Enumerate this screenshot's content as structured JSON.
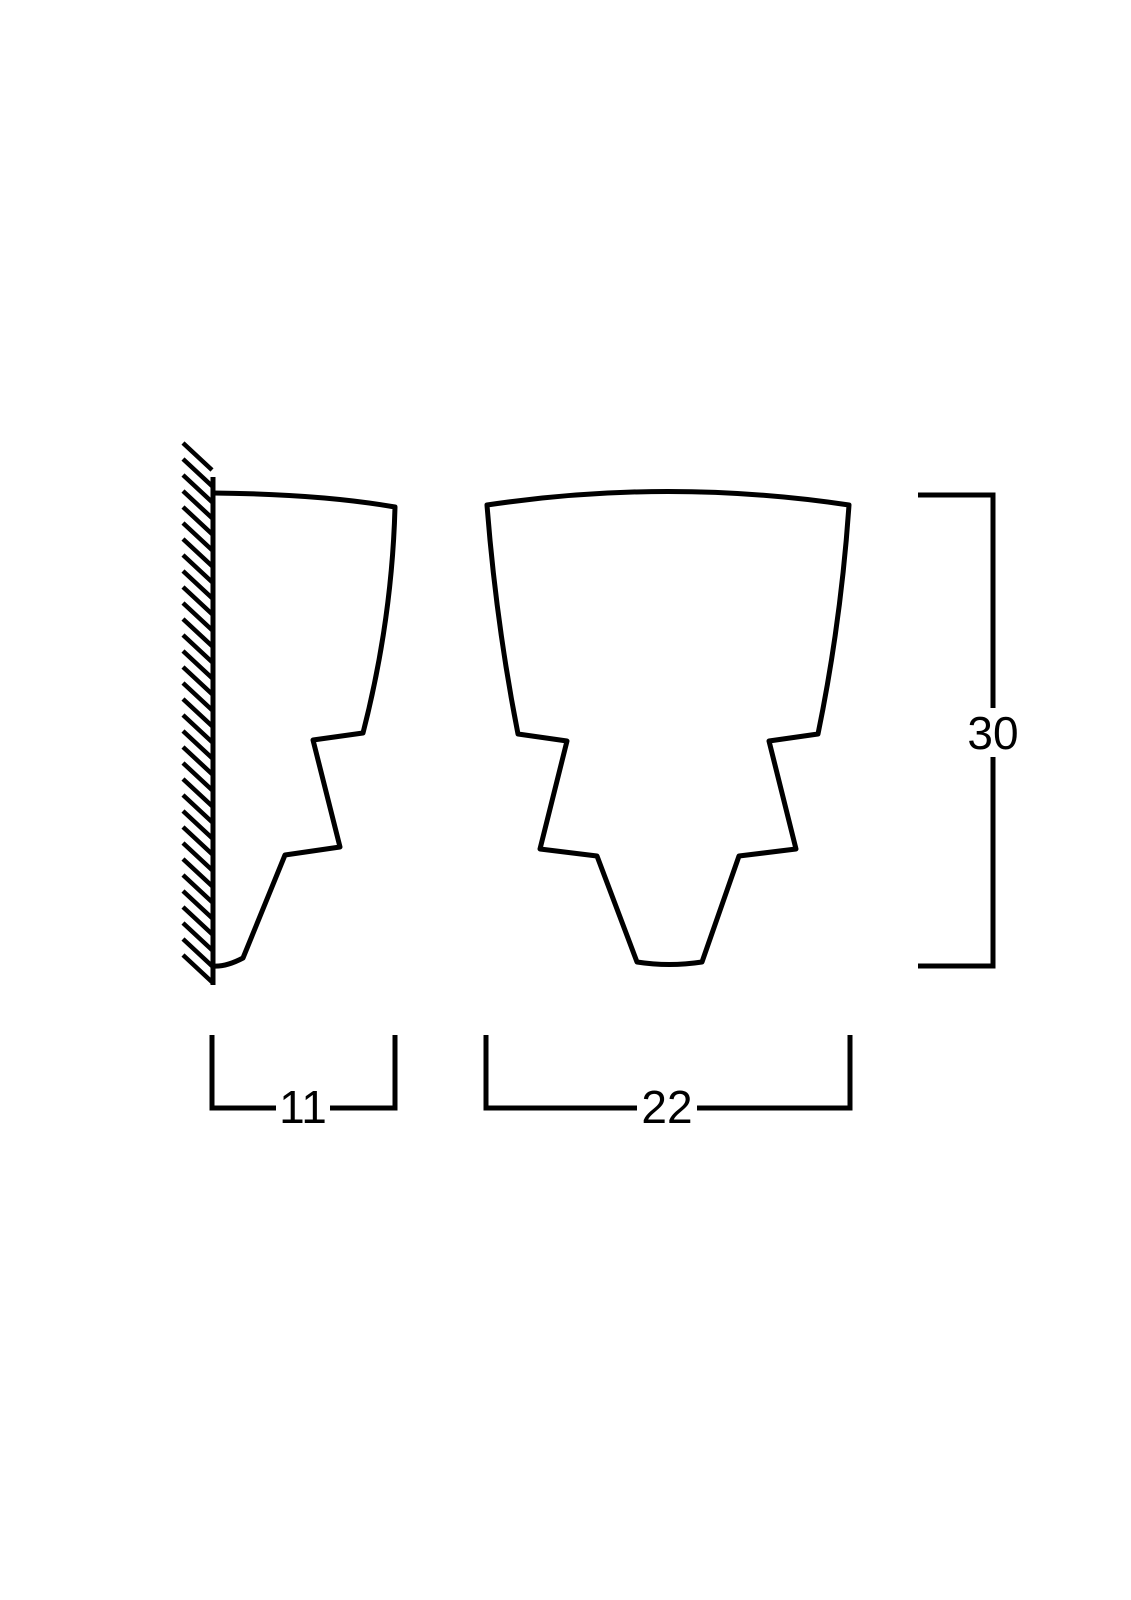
{
  "document": {
    "type": "technical-dimension-drawing",
    "background_color": "#ffffff",
    "line_color": "#000000"
  },
  "dimensions": {
    "side_depth": {
      "label": "11"
    },
    "front_width": {
      "label": "22"
    },
    "height": {
      "label": "30"
    }
  },
  "drawing": {
    "wall": {
      "line_d": "M213 477 L213 985",
      "hatch": {
        "x1": 183,
        "x2": 212,
        "dy": 27,
        "spacing": 16,
        "y_start": 443,
        "y_end": 956
      }
    },
    "side_view": {
      "d": "M213 493 Q320 494 395 507 Q392 620 363 733 L313 740 L340 847 L285 855 L243 958 Q226 967 213 966"
    },
    "front_view": {
      "d": "M487 505 Q668 478 849 505 Q841 622 818 734 L769 741 L796 849 L739 856 L702 962 Q669 967 637 962 L597 856 L540 849 L567 741 L518 734 Q496 622 487 505 Z"
    },
    "dim_side_depth": {
      "left_d": "M212 1035 L212 1108 L276 1108",
      "right_d": "M330 1108 L395 1108 L395 1035",
      "label_x": 303,
      "label_y": 1123
    },
    "dim_front_width": {
      "left_d": "M486 1035 L486 1108 L637 1108",
      "right_d": "M697 1108 L850 1108 L850 1035",
      "label_x": 667,
      "label_y": 1123
    },
    "dim_height": {
      "top_d": "M918 495 L993 495 L993 708",
      "bottom_d": "M993 757 L993 966 L918 966",
      "label_x": 993,
      "label_y": 749
    }
  }
}
